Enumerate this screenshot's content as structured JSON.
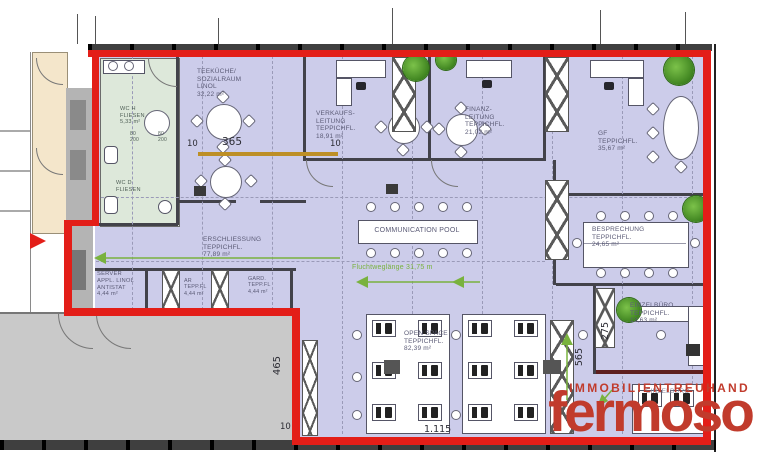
{
  "plan": {
    "rooms": [
      {
        "key": "teekueche",
        "label": "TEEKÜCHE/\nSOZIALRAUM\nLINOL\n32,22 m²"
      },
      {
        "key": "verkaufsleitung",
        "label": "VERKAUFS-\nLEITUNG\nTEPPICHFL.\n18,91 m²"
      },
      {
        "key": "finanzleitung",
        "label": "FINANZ-\nLEITUNG\nTEPPICHFL.\n21,02 m²"
      },
      {
        "key": "gf",
        "label": "GF\nTEPPICHFL.\n35,67 m²"
      },
      {
        "key": "besprechung",
        "label": "BESPRECHUNG\nTEPPICHFL.\n24,65 m²"
      },
      {
        "key": "communication-pool",
        "label": "COMMUNICATION POOL"
      },
      {
        "key": "erschliessung",
        "label": "ERSCHLIESSUNG\nTEPPICHFL.\n77,89 m²"
      },
      {
        "key": "server",
        "label": "SERVER\nAPPL. LINOL\nANTISTAT\n4,44 m²"
      },
      {
        "key": "abstellraum",
        "label": "AR\nTEPP.FL\n4,44 m²"
      },
      {
        "key": "garderobe",
        "label": "GARD.\nTEPP.FL\n4,44 m²"
      },
      {
        "key": "openspace",
        "label": "OPEN SPACE\nTEPPICHFL.\n82,39 m²"
      },
      {
        "key": "einzelbuero-1",
        "label": "EINZELBÜRO\nTEPPICHFL.\n13,63 m²"
      },
      {
        "key": "einzelbuero-2",
        "label": "EINZELBÜRO"
      },
      {
        "key": "wc-h",
        "label": "WC H\nFLIESEN\n5,33 m²"
      },
      {
        "key": "wc-d",
        "label": "WC D\nFLIESEN"
      }
    ],
    "dimensions": {
      "top_left": "10",
      "top_mid": "365",
      "top_right": "10",
      "left_v": "465",
      "bottom_left": "10",
      "bottom": "1.115",
      "mid_v": "565",
      "right_v": "275"
    },
    "door_dims": [
      "80\n200",
      "80\n200"
    ],
    "escape_route": "Fluchtweglänge 31,75 m",
    "colors": {
      "outline": "#e31e18",
      "floor": "#ccccea",
      "wet": "#dde8da",
      "green": "#79b23e",
      "logo": "#c13b2c",
      "orange": "#bd8f26"
    }
  },
  "logo": {
    "tagline": "IMMOBILIENTREUHAND",
    "brand": "fermoso"
  }
}
